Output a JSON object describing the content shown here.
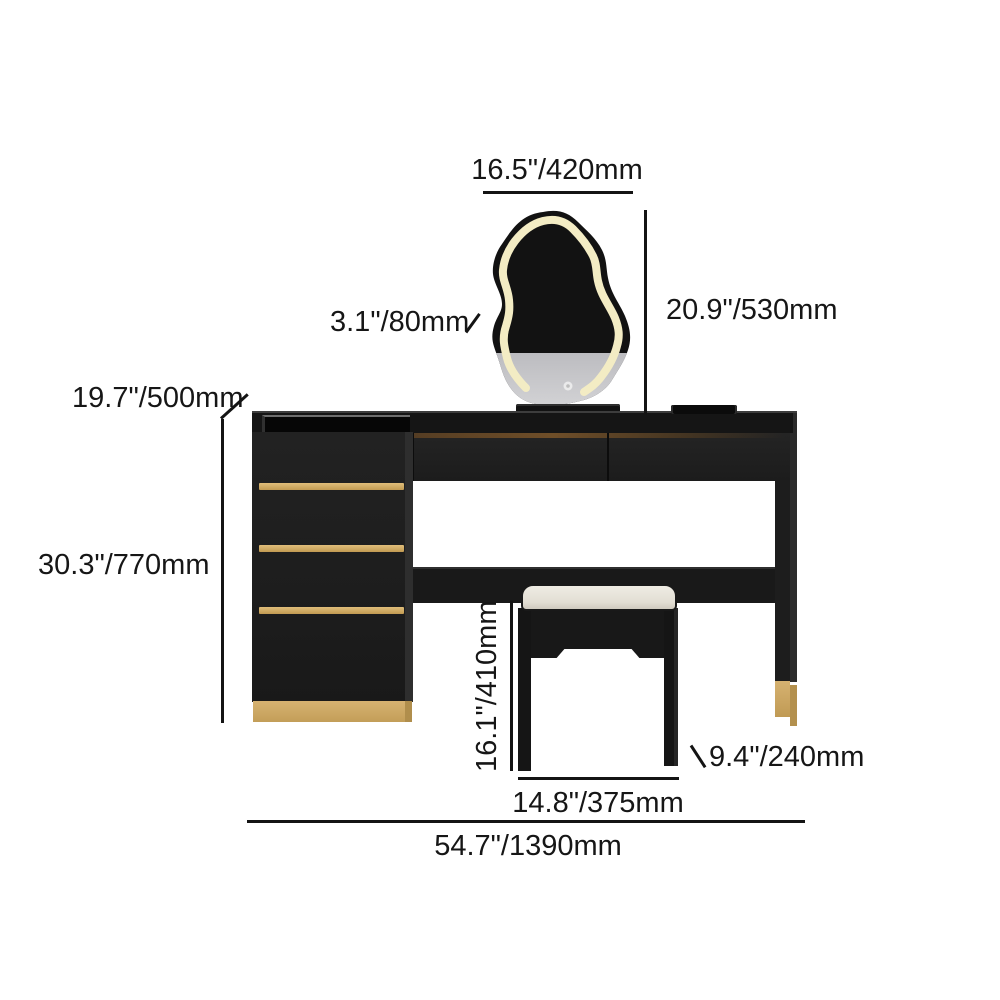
{
  "diagram": {
    "subject": "vanity-desk-with-mirror-and-stool",
    "dims": {
      "mirror_width": "16.5\"/420mm",
      "mirror_height": "20.9\"/530mm",
      "led_frame": "3.1\"/80mm",
      "depth": "19.7\"/500mm",
      "table_height": "30.3\"/770mm",
      "stool_height": "16.1\"/410mm",
      "stool_width": "14.8\"/375mm",
      "stool_depth": "9.4\"/240mm",
      "total_width": "54.7\"/1390mm"
    },
    "colors": {
      "furniture_black": "#1e1e1e",
      "accent_gold": "#c9a25f",
      "led_strip": "#f3ecc4",
      "mirror_silver": "#c9c9cd",
      "cushion_white": "#e8e4da",
      "dimension_line": "#141414",
      "background": "#ffffff"
    }
  }
}
